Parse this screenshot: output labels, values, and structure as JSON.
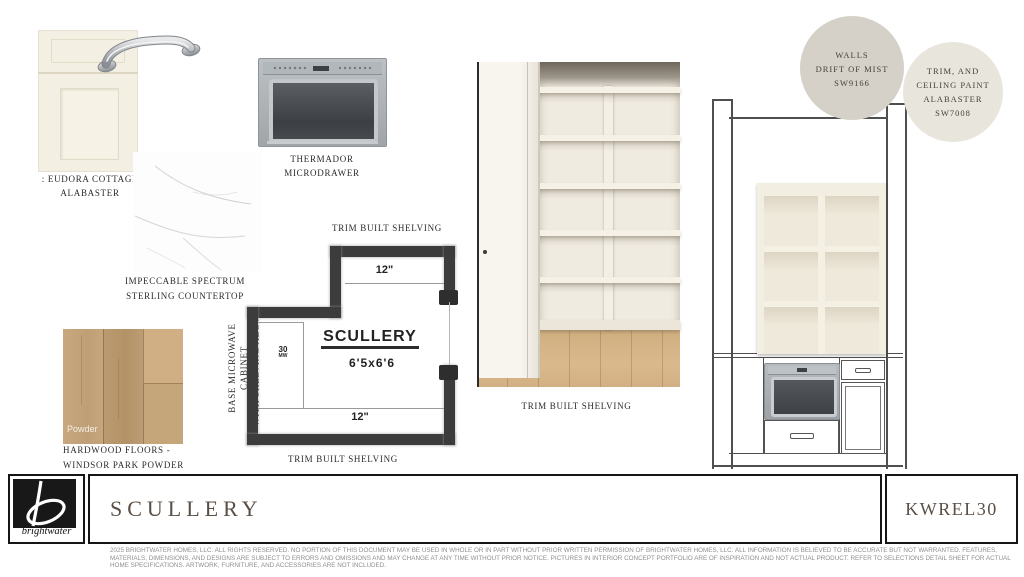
{
  "samples": {
    "cabinet_door": {
      "label1": ": EUDORA COTTAGE",
      "label2": "ALABASTER"
    },
    "microdrawer": {
      "label": "THERMADOR MICRODRAWER"
    },
    "countertop": {
      "label1": "IMPECCABLE SPECTRUM",
      "label2": "STERLING COUNTERTOP"
    },
    "hardwood": {
      "watermark": "Powder",
      "label1": "HARDWOOD FLOORS -",
      "label2": "WINDSOR PARK POWDER"
    }
  },
  "floorplan": {
    "label_top": "TRIM BUILT SHELVING",
    "label_bottom": "TRIM BUILT SHELVING",
    "label_side1": "BASE MICROWAVE CABINET",
    "label_side2": "WITH SHELVING ABOVE",
    "room_name": "SCULLERY",
    "room_dims": "6'5x6'6",
    "shelf_depth_top": "12\"",
    "shelf_depth_bottom": "12\"",
    "microwave_note": "30",
    "microwave_note_sub": "MW"
  },
  "shelving_photo": {
    "label": "TRIM BUILT SHELVING"
  },
  "paint": {
    "walls": {
      "line1": "WALLS",
      "line2": "DRIFT OF MIST",
      "line3": "SW9166",
      "swatch_color": "#d5d0c8"
    },
    "trim": {
      "line1": "TRIM, AND",
      "line2": "CEILING PAINT",
      "line3": "ALABASTER",
      "line4": "SW7008",
      "swatch_color": "#e8e5dc"
    }
  },
  "footer": {
    "brand": "brightwater",
    "title": "SCULLERY",
    "code": "KWREL30",
    "disclaimer1": "2025 BRIGHTWATER HOMES, LLC. ALL RIGHTS RESERVED. NO PORTION OF THIS DOCUMENT MAY BE USED IN WHOLE OR IN PART WITHOUT PRIOR WRITTEN PERMISSION OF BRIGHTWATER HOMES, LLC. ALL INFORMATION IS BELIEVED TO BE ACCURATE BUT NOT WARRANTED. FEATURES,",
    "disclaimer2": "MATERIALS, DIMENSIONS, AND DESIGNS ARE SUBJECT TO ERRORS AND OMISSIONS AND MAY CHANGE AT ANY TIME WITHOUT PRIOR NOTICE. PICTURES IN INTERIOR CONCEPT PORTFOLIO ARE OF INSPIRATION AND NOT ACTUAL PRODUCT. REFER TO SELECTIONS DETAIL SHEET FOR ACTUAL",
    "disclaimer3": "HOME SPECIFICATIONS. ARTWORK, FURNITURE, AND ACCESSORIES ARE NOT INCLUDED."
  }
}
